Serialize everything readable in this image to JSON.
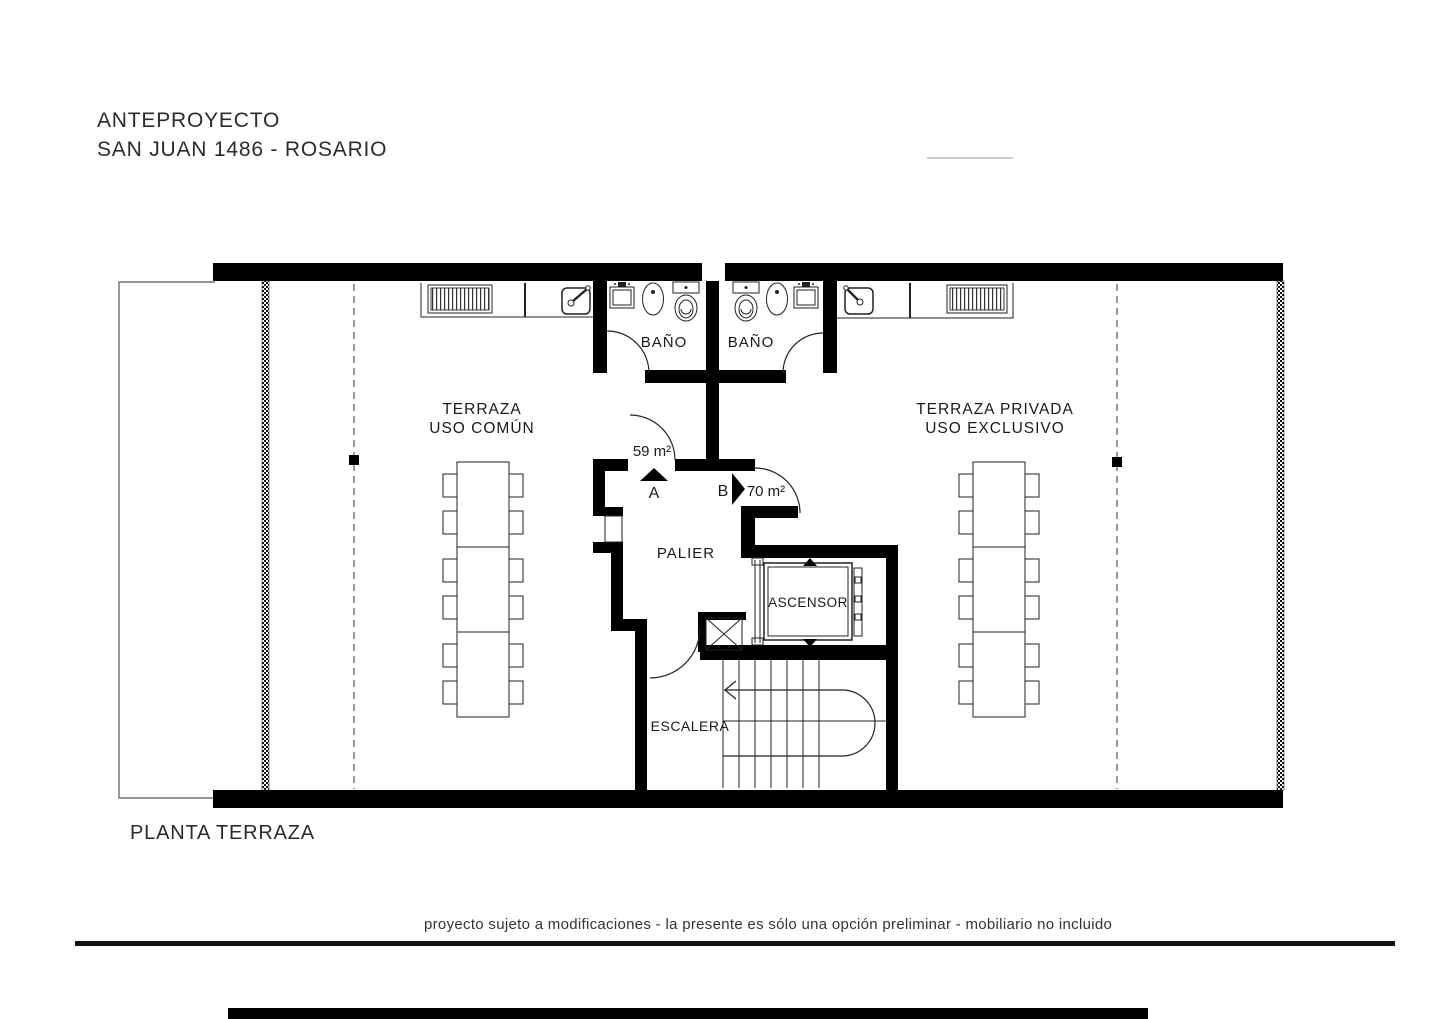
{
  "header": {
    "project_type": "ANTEPROYECTO",
    "project_address": "SAN JUAN 1486 - ROSARIO"
  },
  "plan": {
    "title": "PLANTA TERRAZA",
    "labels": {
      "terrace_common_1": "TERRAZA",
      "terrace_common_2": "USO COMÚN",
      "terrace_private_1": "TERRAZA PRIVADA",
      "terrace_private_2": "USO EXCLUSIVO",
      "bathroom_left": "BAÑO",
      "bathroom_right": "BAÑO",
      "landing": "PALIER",
      "elevator": "ASCENSOR",
      "stairs": "ESCALERA"
    },
    "units": {
      "a_label": "A",
      "a_area": "59 m²",
      "b_label": "B",
      "b_area": "70 m²"
    }
  },
  "footer": {
    "disclaimer": "proyecto sujeto a modificaciones - la presente es sólo una opción preliminar - mobiliario no incluido"
  },
  "colors": {
    "wall": "#000000",
    "ink": "#1a1a1a",
    "line": "#222222",
    "background": "#ffffff"
  }
}
